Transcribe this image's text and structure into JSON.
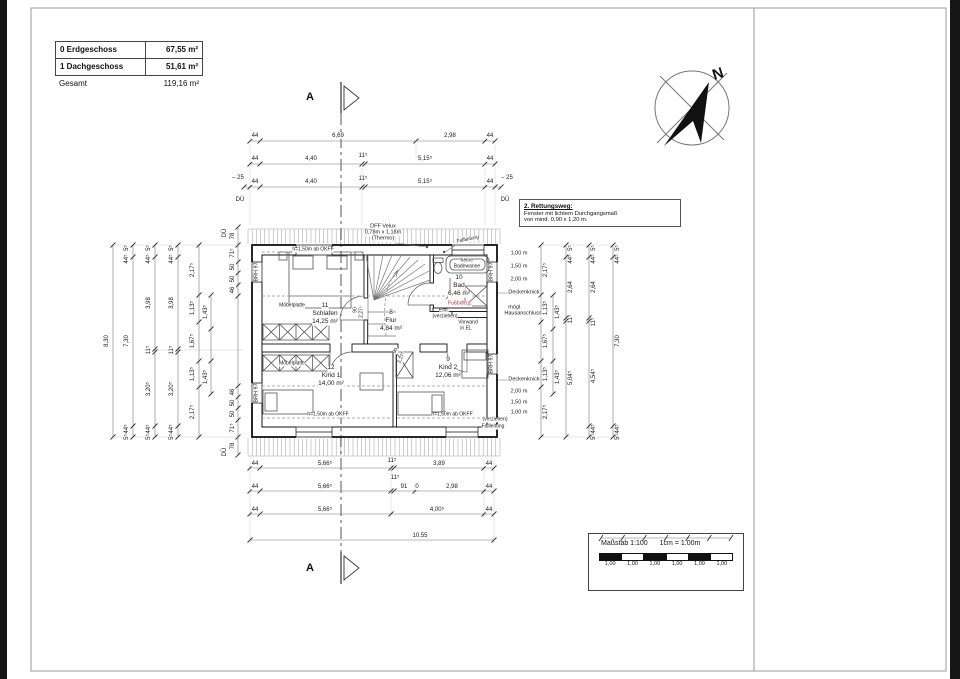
{
  "title_block": {
    "rows": [
      {
        "label": "0 Erdgeschoss",
        "value": "67,55 m²"
      },
      {
        "label": "1 Dachgeschoss",
        "value": "51,61 m²"
      },
      {
        "label": "Gesamt",
        "value": "119,16 m²"
      }
    ]
  },
  "compass": {
    "label": "N"
  },
  "section": {
    "label": "A"
  },
  "rescue_note": {
    "title": "2. Rettungsweg:",
    "lines": [
      "Fenster mit lichtem Durchgangsmaß",
      "von mind. 0,90 x 1,20 m."
    ]
  },
  "scale_bar": {
    "title": "Maßstab 1:100",
    "subtitle": "1cm = 1.00m",
    "segments": [
      "1,00",
      "1,00",
      "1,00",
      "1,00",
      "1,00",
      "1,00"
    ]
  },
  "rooms": [
    {
      "number": "11",
      "name": "Schlafen",
      "area": "14,25 m²",
      "x": 325,
      "y": 306
    },
    {
      "number": "8",
      "name": "Flur",
      "area": "4,84 m²",
      "x": 391,
      "y": 313
    },
    {
      "number": "10",
      "name": "Bad",
      "area": "6,46 m²",
      "x": 459,
      "y": 278
    },
    {
      "number": "12",
      "name": "Kind 1",
      "area": "14,00 m²",
      "x": 331,
      "y": 368
    },
    {
      "number": "9",
      "name": "Kind 2",
      "area": "12,06 m²",
      "x": 448,
      "y": 360
    }
  ],
  "labels": {
    "dim_top": [
      {
        "t": "44",
        "x": 255,
        "y": 136
      },
      {
        "t": "6,69",
        "x": 338,
        "y": 136
      },
      {
        "t": "2,98",
        "x": 450,
        "y": 136
      },
      {
        "t": "44",
        "x": 490,
        "y": 136
      },
      {
        "t": "44",
        "x": 255,
        "y": 159
      },
      {
        "t": "4,40",
        "x": 311,
        "y": 159
      },
      {
        "t": "11⁵",
        "x": 363,
        "y": 156
      },
      {
        "t": "5,15⁵",
        "x": 425,
        "y": 159
      },
      {
        "t": "44",
        "x": 490,
        "y": 159
      },
      {
        "t": "– 25",
        "x": 238,
        "y": 178
      },
      {
        "t": "44",
        "x": 255,
        "y": 182
      },
      {
        "t": "4,40",
        "x": 311,
        "y": 182
      },
      {
        "t": "11⁵",
        "x": 363,
        "y": 179
      },
      {
        "t": "5,15⁵",
        "x": 425,
        "y": 182
      },
      {
        "t": "44",
        "x": 490,
        "y": 182
      },
      {
        "t": "– 25",
        "x": 507,
        "y": 178
      },
      {
        "t": "DÜ",
        "x": 240,
        "y": 200
      },
      {
        "t": "DÜ",
        "x": 505,
        "y": 200
      }
    ],
    "dim_bottom": [
      {
        "t": "44",
        "x": 255,
        "y": 464
      },
      {
        "t": "5,66⁵",
        "x": 325,
        "y": 464
      },
      {
        "t": "11⁵",
        "x": 392,
        "y": 461
      },
      {
        "t": "3,89",
        "x": 439,
        "y": 464
      },
      {
        "t": "44",
        "x": 489,
        "y": 464
      },
      {
        "t": "44",
        "x": 255,
        "y": 487
      },
      {
        "t": "5,66⁵",
        "x": 325,
        "y": 487
      },
      {
        "t": "11⁵",
        "x": 395,
        "y": 478
      },
      {
        "t": "91",
        "x": 404,
        "y": 487
      },
      {
        "t": "0",
        "x": 417,
        "y": 487
      },
      {
        "t": "2,98",
        "x": 452,
        "y": 487
      },
      {
        "t": "44",
        "x": 489,
        "y": 487
      },
      {
        "t": "44",
        "x": 255,
        "y": 510
      },
      {
        "t": "5,66⁵",
        "x": 325,
        "y": 510
      },
      {
        "t": "4,00⁵",
        "x": 437,
        "y": 510
      },
      {
        "t": "44",
        "x": 489,
        "y": 510
      },
      {
        "t": "10,55",
        "x": 420,
        "y": 536
      }
    ],
    "dim_left": [
      {
        "t": "8,30",
        "x": 107,
        "y": 341,
        "r": -90
      },
      {
        "t": "5⁵",
        "x": 127,
        "y": 248,
        "r": -90
      },
      {
        "t": "44⁵",
        "x": 127,
        "y": 259,
        "r": -90
      },
      {
        "t": "7,30",
        "x": 127,
        "y": 341,
        "r": -90
      },
      {
        "t": "44⁵",
        "x": 127,
        "y": 429,
        "r": -90
      },
      {
        "t": "5⁵",
        "x": 127,
        "y": 437,
        "r": -90
      },
      {
        "t": "5⁵",
        "x": 149,
        "y": 248,
        "r": -90
      },
      {
        "t": "44⁵",
        "x": 149,
        "y": 259,
        "r": -90
      },
      {
        "t": "3,98",
        "x": 149,
        "y": 303,
        "r": -90
      },
      {
        "t": "11⁵",
        "x": 149,
        "y": 350,
        "r": -90
      },
      {
        "t": "3,20⁵",
        "x": 149,
        "y": 389,
        "r": -90
      },
      {
        "t": "44⁵",
        "x": 149,
        "y": 429,
        "r": -90
      },
      {
        "t": "5⁵",
        "x": 149,
        "y": 437,
        "r": -90
      },
      {
        "t": "5⁵",
        "x": 172,
        "y": 248,
        "r": -90
      },
      {
        "t": "44⁵",
        "x": 172,
        "y": 259,
        "r": -90
      },
      {
        "t": "3,98",
        "x": 172,
        "y": 303,
        "r": -90
      },
      {
        "t": "11⁵",
        "x": 172,
        "y": 350,
        "r": -90
      },
      {
        "t": "3,20⁵",
        "x": 172,
        "y": 389,
        "r": -90
      },
      {
        "t": "44⁵",
        "x": 172,
        "y": 429,
        "r": -90
      },
      {
        "t": "5⁵",
        "x": 172,
        "y": 437,
        "r": -90
      },
      {
        "t": "2,17⁵",
        "x": 193,
        "y": 270,
        "r": -90
      },
      {
        "t": "1,13⁵",
        "x": 193,
        "y": 308,
        "r": -90
      },
      {
        "t": "1,67⁵",
        "x": 193,
        "y": 341,
        "r": -90
      },
      {
        "t": "1,13⁵",
        "x": 193,
        "y": 374,
        "r": -90
      },
      {
        "t": "2,17⁵",
        "x": 193,
        "y": 412,
        "r": -90
      },
      {
        "t": "1,43⁵",
        "x": 206,
        "y": 312,
        "r": -90
      },
      {
        "t": "1,43⁵",
        "x": 206,
        "y": 377,
        "r": -90
      },
      {
        "t": "78",
        "x": 233,
        "y": 236,
        "r": -90
      },
      {
        "t": "71⁵",
        "x": 233,
        "y": 253,
        "r": -90
      },
      {
        "t": "50",
        "x": 233,
        "y": 267,
        "r": -90
      },
      {
        "t": "50",
        "x": 233,
        "y": 279,
        "r": -90
      },
      {
        "t": "46",
        "x": 233,
        "y": 290,
        "r": -90
      },
      {
        "t": "46",
        "x": 233,
        "y": 392,
        "r": -90
      },
      {
        "t": "50",
        "x": 233,
        "y": 403,
        "r": -90
      },
      {
        "t": "50",
        "x": 233,
        "y": 414,
        "r": -90
      },
      {
        "t": "71⁵",
        "x": 233,
        "y": 428,
        "r": -90
      },
      {
        "t": "78",
        "x": 233,
        "y": 446,
        "r": -90
      },
      {
        "t": "DÜ",
        "x": 225,
        "y": 233,
        "r": -90
      },
      {
        "t": "DÜ",
        "x": 225,
        "y": 452,
        "r": -90
      }
    ],
    "dim_right": [
      {
        "t": "2,17⁵",
        "x": 546,
        "y": 270,
        "r": -90
      },
      {
        "t": "1,13⁵",
        "x": 546,
        "y": 308,
        "r": -90
      },
      {
        "t": "1,67⁵",
        "x": 546,
        "y": 341,
        "r": -90
      },
      {
        "t": "1,13⁵",
        "x": 546,
        "y": 374,
        "r": -90
      },
      {
        "t": "2,17⁵",
        "x": 546,
        "y": 412,
        "r": -90
      },
      {
        "t": "1,43⁵",
        "x": 558,
        "y": 312,
        "r": -90
      },
      {
        "t": "1,43⁵",
        "x": 558,
        "y": 377,
        "r": -90
      },
      {
        "t": "5⁵",
        "x": 571,
        "y": 248,
        "r": -90
      },
      {
        "t": "44⁵",
        "x": 571,
        "y": 259,
        "r": -90
      },
      {
        "t": "2,64",
        "x": 571,
        "y": 287,
        "r": -90
      },
      {
        "t": "11⁵",
        "x": 571,
        "y": 319,
        "r": -90
      },
      {
        "t": "5,04⁵",
        "x": 571,
        "y": 378,
        "r": -90
      },
      {
        "t": "5⁵",
        "x": 594,
        "y": 248,
        "r": -90
      },
      {
        "t": "44⁵",
        "x": 594,
        "y": 259,
        "r": -90
      },
      {
        "t": "2,64",
        "x": 594,
        "y": 287,
        "r": -90
      },
      {
        "t": "11⁵",
        "x": 594,
        "y": 322,
        "r": -90
      },
      {
        "t": "4,54⁵",
        "x": 594,
        "y": 376,
        "r": -90
      },
      {
        "t": "44⁵",
        "x": 594,
        "y": 429,
        "r": -90
      },
      {
        "t": "5⁵",
        "x": 594,
        "y": 437,
        "r": -90
      },
      {
        "t": "5⁵",
        "x": 618,
        "y": 248,
        "r": -90
      },
      {
        "t": "44⁵",
        "x": 618,
        "y": 259,
        "r": -90
      },
      {
        "t": "7,30",
        "x": 618,
        "y": 341,
        "r": -90
      },
      {
        "t": "44⁵",
        "x": 618,
        "y": 429,
        "r": -90
      },
      {
        "t": "5⁵",
        "x": 618,
        "y": 437,
        "r": -90
      }
    ],
    "roof_heights": [
      {
        "t": "1,00 m",
        "x": 519,
        "y": 254,
        "s": 5.5
      },
      {
        "t": "1,50 m",
        "x": 519,
        "y": 267,
        "s": 5.5
      },
      {
        "t": "2,00 m",
        "x": 519,
        "y": 280,
        "s": 5.5
      },
      {
        "t": "Deckenknick",
        "x": 524,
        "y": 293,
        "s": 5.5
      },
      {
        "t": "mögl.",
        "x": 515,
        "y": 308,
        "s": 5.5
      },
      {
        "t": "Hausanschluss",
        "x": 523,
        "y": 314,
        "s": 5.5
      },
      {
        "t": "Deckenknick",
        "x": 524,
        "y": 380,
        "s": 5.5
      },
      {
        "t": "2,00 m",
        "x": 519,
        "y": 392,
        "s": 5.5
      },
      {
        "t": "1,50 m",
        "x": 519,
        "y": 403,
        "s": 5.5
      },
      {
        "t": "1,00 m",
        "x": 519,
        "y": 413,
        "s": 5.5
      },
      {
        "t": "(verziehen)",
        "x": 495,
        "y": 420,
        "s": 5
      },
      {
        "t": "Fallleitung",
        "x": 493,
        "y": 427,
        "s": 5
      }
    ],
    "wall_labels": [
      {
        "t": "BRH 97",
        "x": 257,
        "y": 272,
        "r": -90,
        "s": 5.5
      },
      {
        "t": "BRH 97",
        "x": 257,
        "y": 393,
        "r": -90,
        "s": 5.5
      },
      {
        "t": "BRH 97",
        "x": 492,
        "y": 272,
        "r": -90,
        "s": 5.5
      },
      {
        "t": "BRH 97",
        "x": 492,
        "y": 364,
        "r": -90,
        "s": 5.5
      }
    ],
    "notes": [
      {
        "t": "Möbelplatte",
        "x": 292,
        "y": 306,
        "s": 5
      },
      {
        "t": "Möbelplatte",
        "x": 292,
        "y": 364,
        "s": 5
      },
      {
        "t": "Vorwand",
        "x": 468,
        "y": 323,
        "s": 5
      },
      {
        "t": "in EL",
        "x": 466,
        "y": 329,
        "s": 5
      },
      {
        "t": "Entl.",
        "x": 444,
        "y": 311,
        "s": 5
      },
      {
        "t": "(verziehen)",
        "x": 445,
        "y": 317,
        "s": 5
      },
      {
        "t": "keine",
        "x": 467,
        "y": 261,
        "s": 5
      },
      {
        "t": "Badewanne",
        "x": 467,
        "y": 267,
        "s": 5
      },
      {
        "t": "DFF Velux",
        "x": 383,
        "y": 227,
        "s": 5.5
      },
      {
        "t": "0,78m x 1,18m",
        "x": 383,
        "y": 233,
        "s": 5.5
      },
      {
        "t": "(Thermo)",
        "x": 383,
        "y": 239,
        "s": 5.5
      },
      {
        "t": "Fallleitung",
        "x": 468,
        "y": 240,
        "s": 5,
        "r": -12
      },
      {
        "t": "h=1,50m ab OKFF",
        "x": 313,
        "y": 250,
        "s": 5
      },
      {
        "t": "h=1,50m ab OKFF",
        "x": 328,
        "y": 415,
        "s": 5
      },
      {
        "t": "h=1,50m ab OKFF",
        "x": 452,
        "y": 415,
        "s": 5
      },
      {
        "t": "90",
        "x": 356,
        "y": 310,
        "s": 5,
        "r": -90
      },
      {
        "t": "2,27⁵",
        "x": 362,
        "y": 312,
        "s": 5,
        "r": -90
      },
      {
        "t": "90",
        "x": 396,
        "y": 351,
        "s": 5,
        "r": -65
      },
      {
        "t": "2,27⁵",
        "x": 402,
        "y": 358,
        "s": 5,
        "r": -65
      },
      {
        "t": "Fußbdhzg.",
        "x": 460,
        "y": 304,
        "s": 5,
        "c": "#b03030"
      }
    ]
  }
}
